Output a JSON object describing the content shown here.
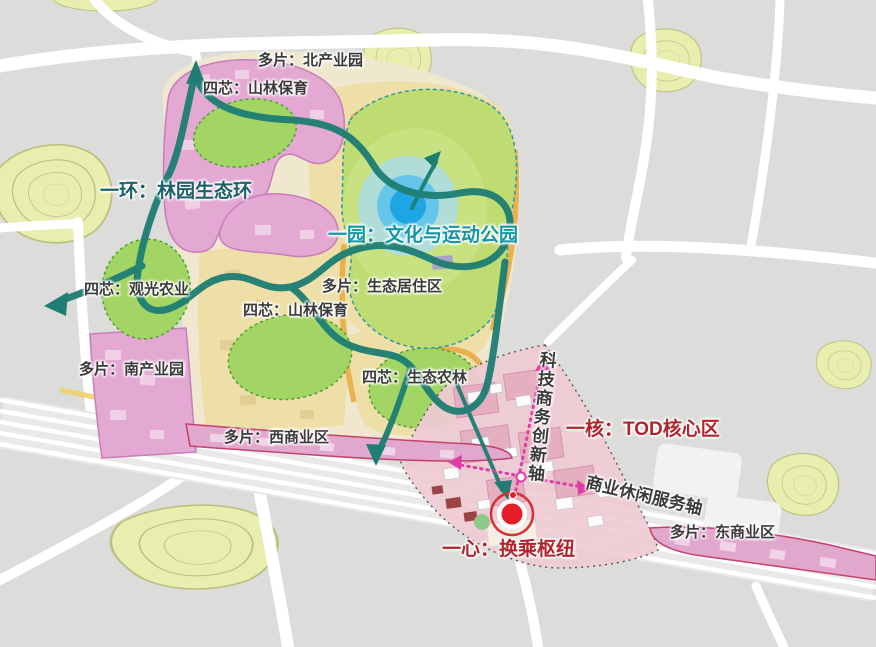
{
  "map": {
    "title": "TOD概念规划结构图",
    "accent_colors": {
      "ring_teal": "#1f7e74",
      "feature_teal": "#1496a6",
      "dark_teal_label": "#1d5f6a",
      "core_red": "#b3232b",
      "axis_magenta": "#de3da6",
      "district_pink": "#e3a9d3",
      "commercial_border": "#c2426e",
      "core_green": "#a2d563",
      "park_green": "#bfdc73",
      "residential_yellow": "#eedfa8",
      "hill_green": "#e9edae",
      "park_center_blue": "#1ea6e4"
    },
    "icons": {
      "transfer_hub": "red-concentric-circles-icon",
      "park_center": "blue-concentric-circles-icon",
      "flow_arrow": "teal-arrowhead-icon",
      "axis_arrow": "magenta-arrowhead-icon"
    },
    "labels": [
      {
        "id": "north-industrial-park",
        "text": "多片：北产业园",
        "x": 258,
        "y": 53,
        "color": "#3b3b3b",
        "size": 15
      },
      {
        "id": "forest-conservation-north",
        "text": "四芯：山林保育",
        "x": 203,
        "y": 81,
        "color": "#3b3b3b",
        "size": 15
      },
      {
        "id": "garden-eco-ring",
        "text": "一环：林园生态环",
        "x": 100,
        "y": 182,
        "color": "#1d5f6a",
        "size": 19
      },
      {
        "id": "culture-sports-park",
        "text": "一园：文化与运动公园",
        "x": 328,
        "y": 226,
        "color": "#1496a6",
        "size": 19
      },
      {
        "id": "sightseeing-agriculture",
        "text": "四芯：观光农业",
        "x": 84,
        "y": 282,
        "color": "#3b3b3b",
        "size": 15
      },
      {
        "id": "eco-residential-area",
        "text": "多片：生态居住区",
        "x": 322,
        "y": 279,
        "color": "#3b3b3b",
        "size": 15
      },
      {
        "id": "forest-conservation-south",
        "text": "四芯：山林保育",
        "x": 243,
        "y": 303,
        "color": "#3b3b3b",
        "size": 15
      },
      {
        "id": "south-industrial-park",
        "text": "多片：南产业园",
        "x": 79,
        "y": 362,
        "color": "#3b3b3b",
        "size": 15
      },
      {
        "id": "eco-agriculture-forestry",
        "text": "四芯：生态农林",
        "x": 362,
        "y": 370,
        "color": "#3b3b3b",
        "size": 15
      },
      {
        "id": "west-commercial-district",
        "text": "多片：西商业区",
        "x": 224,
        "y": 430,
        "color": "#3b3b3b",
        "size": 15
      },
      {
        "id": "tod-core-area",
        "text": "一核：TOD核心区",
        "x": 566,
        "y": 420,
        "color": "#b3232b",
        "size": 19
      },
      {
        "id": "tech-business-innovation-axis",
        "text": "科技商务创新轴",
        "x": 538,
        "y": 350,
        "color": "#3b3b3b",
        "size": 17,
        "vertical": true,
        "rot": 6
      },
      {
        "id": "business-leisure-service-axis",
        "text": "商业休闲服务轴",
        "x": 588,
        "y": 474,
        "color": "#3b3b3b",
        "size": 17,
        "rot": 13
      },
      {
        "id": "transfer-hub",
        "text": "一心：换乘枢纽",
        "x": 442,
        "y": 540,
        "color": "#b3232b",
        "size": 19
      },
      {
        "id": "east-commercial-district",
        "text": "多片：东商业区",
        "x": 670,
        "y": 525,
        "color": "#3b3b3b",
        "size": 15
      }
    ]
  }
}
